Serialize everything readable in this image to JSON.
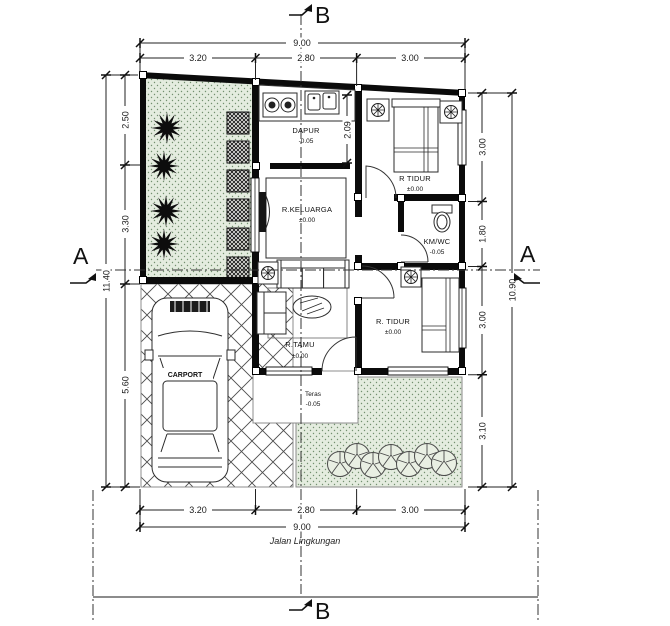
{
  "markers": {
    "a_left": "A",
    "a_right": "A",
    "b_top": "B",
    "b_bottom": "B"
  },
  "street_label": "Jalan Lingkungan",
  "dims": {
    "top": {
      "total": "9.00",
      "segments": [
        "3.20",
        "2.80",
        "3.00"
      ]
    },
    "bottom": {
      "total": "9.00",
      "segments": [
        "3.20",
        "2.80",
        "3.00"
      ]
    },
    "left": {
      "total": "11.40",
      "segments": [
        "2.50",
        "3.30",
        "5.60"
      ]
    },
    "right": {
      "total": "10.90",
      "segments": [
        "3.00",
        "1.80",
        "3.00",
        "3.10"
      ]
    },
    "kitchen_depth": "2.09"
  },
  "rooms": {
    "dapur": {
      "name": "DAPUR",
      "level": "-0.05"
    },
    "keluarga": {
      "name": "R.KELUARGA",
      "level": "±0.00"
    },
    "tidur1": {
      "name": "R TIDUR",
      "level": "±0.00"
    },
    "kmwc": {
      "name": "KM/WC",
      "level": "-0.05"
    },
    "tidur2": {
      "name": "R. TIDUR",
      "level": "±0.00"
    },
    "tamu": {
      "name": "R.TAMU",
      "level": "±0.00"
    },
    "teras": {
      "name": "Teras",
      "level": "-0.05"
    },
    "carport": {
      "name": "CARPORT"
    }
  },
  "colors": {
    "wall": "#0b0b0b",
    "garden_fill": "#e4ecdf",
    "garden_dot": "#73906f",
    "dimension_line": "#222222",
    "road_line": "#8c8c8c"
  }
}
